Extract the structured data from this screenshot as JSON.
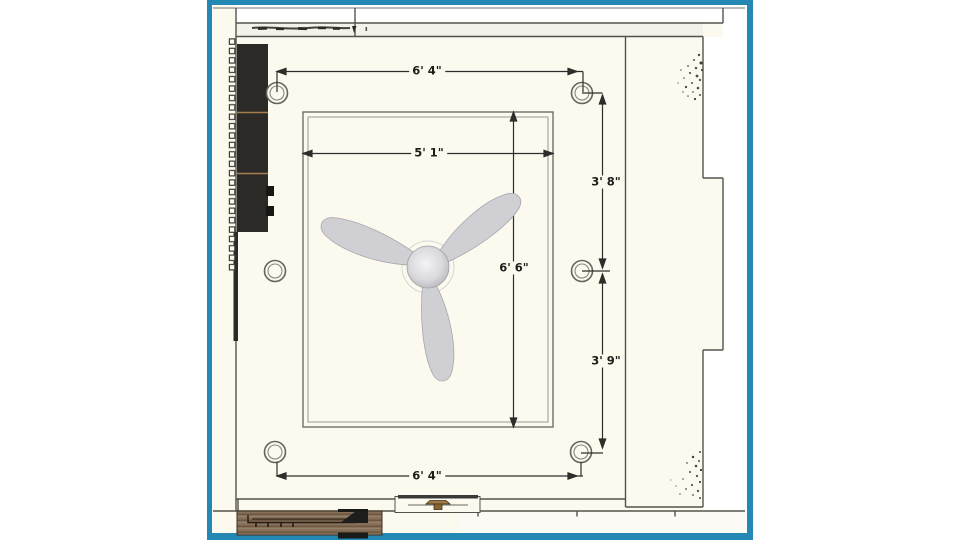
{
  "drawing": {
    "kind": "ceiling-plan",
    "recessed_light_count": 6,
    "fan_blade_count": 3
  },
  "dimensions": {
    "top_width": "6' 4\"",
    "ceiling_inner_width": "5' 1\"",
    "ceiling_inner_height": "6' 6\"",
    "right_upper_spacing": "3' 8\"",
    "right_lower_spacing": "3' 9\"",
    "bottom_width": "6' 4\""
  },
  "colors": {
    "frame_border": "#2488b4",
    "paper": "#fcfaef",
    "window_band": "#f2f1ea",
    "wall_line": "#55524c",
    "dimension_line": "#2f2d2a",
    "cabinet_black": "#2b2a27",
    "cabinet_trim_tan": "#a57e4e",
    "wood_counter": "#87705a",
    "fan_blade": "#cfcfd4",
    "plant_foliage": "#4a4e3e"
  },
  "icons": {
    "ceiling_fan": "three-blade-fan-top-view",
    "recessed_light": "double-ring-circle",
    "dimension_arrow": "solid-triangle"
  }
}
